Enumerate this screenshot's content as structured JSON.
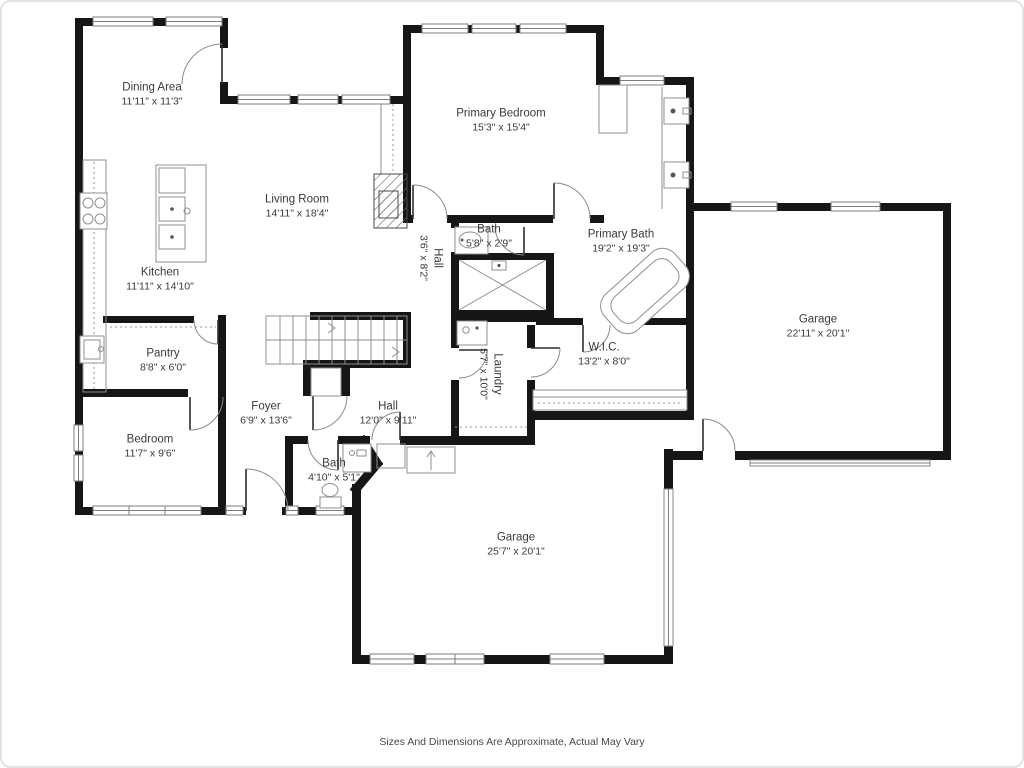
{
  "plan": {
    "caption": "Sizes And Dimensions Are Approximate, Actual May Vary",
    "wall_color": "#161616",
    "text_color": "#3a3a3a",
    "rooms": [
      {
        "name": "Dining Area",
        "dims": "11'11\" x 11'3\"",
        "x": 152,
        "y": 95,
        "rotated": false
      },
      {
        "name": "Living Room",
        "dims": "14'11\" x 18'4\"",
        "x": 297,
        "y": 207,
        "rotated": false
      },
      {
        "name": "Kitchen",
        "dims": "11'11\" x 14'10\"",
        "x": 160,
        "y": 280,
        "rotated": false
      },
      {
        "name": "Pantry",
        "dims": "8'8\" x 6'0\"",
        "x": 163,
        "y": 361,
        "rotated": false
      },
      {
        "name": "Bedroom",
        "dims": "11'7\" x 9'6\"",
        "x": 150,
        "y": 447,
        "rotated": false
      },
      {
        "name": "Foyer",
        "dims": "6'9\" x 13'6\"",
        "x": 266,
        "y": 414,
        "rotated": false
      },
      {
        "name": "Hall",
        "dims": "12'0\" x 9'11\"",
        "x": 388,
        "y": 414,
        "rotated": false
      },
      {
        "name": "Bath",
        "dims": "4'10\" x 5'1\"",
        "x": 334,
        "y": 471,
        "rotated": false
      },
      {
        "name": "Garage",
        "dims": "25'7\" x 20'1\"",
        "x": 516,
        "y": 545,
        "rotated": false
      },
      {
        "name": "Garage",
        "dims": "22'11\" x 20'1\"",
        "x": 818,
        "y": 327,
        "rotated": false
      },
      {
        "name": "Primary Bedroom",
        "dims": "15'3\" x 15'4\"",
        "x": 501,
        "y": 121,
        "rotated": false
      },
      {
        "name": "Bath",
        "dims": "5'8\" x 2'9\"",
        "x": 489,
        "y": 237,
        "rotated": false
      },
      {
        "name": "Primary Bath",
        "dims": "19'2\" x 19'3\"",
        "x": 621,
        "y": 242,
        "rotated": false
      },
      {
        "name": "W.I.C.",
        "dims": "13'2\" x 8'0\"",
        "x": 604,
        "y": 355,
        "rotated": false
      },
      {
        "name": "Laundry",
        "dims": "5'7\" x 10'0\"",
        "x": 490,
        "y": 374,
        "rotated": true
      },
      {
        "name": "Hall",
        "dims": "3'6\" x 8'2\"",
        "x": 430,
        "y": 258,
        "rotated": true
      }
    ]
  }
}
